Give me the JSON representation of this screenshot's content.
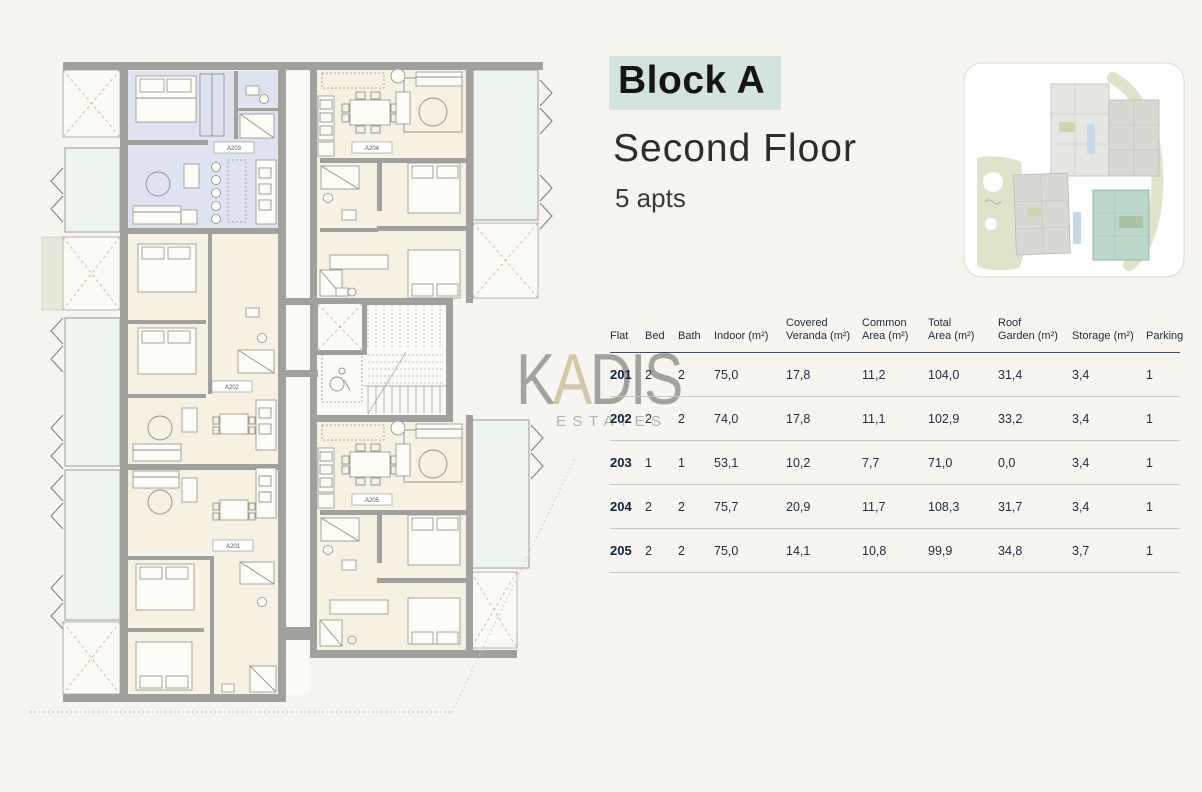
{
  "header": {
    "block_label": "Block A",
    "floor_label": "Second Floor",
    "apts_label": "5 apts"
  },
  "watermark": {
    "k": "K",
    "a": "A",
    "dis": "DIS",
    "estates": "ESTATES"
  },
  "plan": {
    "labels": [
      "A203",
      "A204",
      "A202",
      "A201",
      "A205"
    ]
  },
  "colors": {
    "highlight_mint": "#d3e4df",
    "thumbnail_teal": "#bad7ca",
    "plan_highlight_blue": "#dfe3f1",
    "plan_room_cream": "#f6f1e1",
    "balcony_mint": "#edf5ee"
  },
  "table": {
    "columns": [
      "Flat",
      "Bed",
      "Bath",
      "Indoor (m²)",
      "Covered\nVeranda (m²)",
      "Common\nArea (m²)",
      "Total\nArea (m²)",
      "Roof\nGarden (m²)",
      "Storage (m²)",
      "Parking"
    ],
    "rows": [
      {
        "flat": "201",
        "bed": "2",
        "bath": "2",
        "indoor": "75,0",
        "veranda": "17,8",
        "common": "11,2",
        "total": "104,0",
        "roof": "31,4",
        "storage": "3,4",
        "parking": "1"
      },
      {
        "flat": "202",
        "bed": "2",
        "bath": "2",
        "indoor": "74,0",
        "veranda": "17,8",
        "common": "11,1",
        "total": "102,9",
        "roof": "33,2",
        "storage": "3,4",
        "parking": "1"
      },
      {
        "flat": "203",
        "bed": "1",
        "bath": "1",
        "indoor": "53,1",
        "veranda": "10,2",
        "common": "7,7",
        "total": "71,0",
        "roof": "0,0",
        "storage": "3,4",
        "parking": "1"
      },
      {
        "flat": "204",
        "bed": "2",
        "bath": "2",
        "indoor": "75,7",
        "veranda": "20,9",
        "common": "11,7",
        "total": "108,3",
        "roof": "31,7",
        "storage": "3,4",
        "parking": "1"
      },
      {
        "flat": "205",
        "bed": "2",
        "bath": "2",
        "indoor": "75,0",
        "veranda": "14,1",
        "common": "10,8",
        "total": "99,9",
        "roof": "34,8",
        "storage": "3,7",
        "parking": "1"
      }
    ]
  }
}
